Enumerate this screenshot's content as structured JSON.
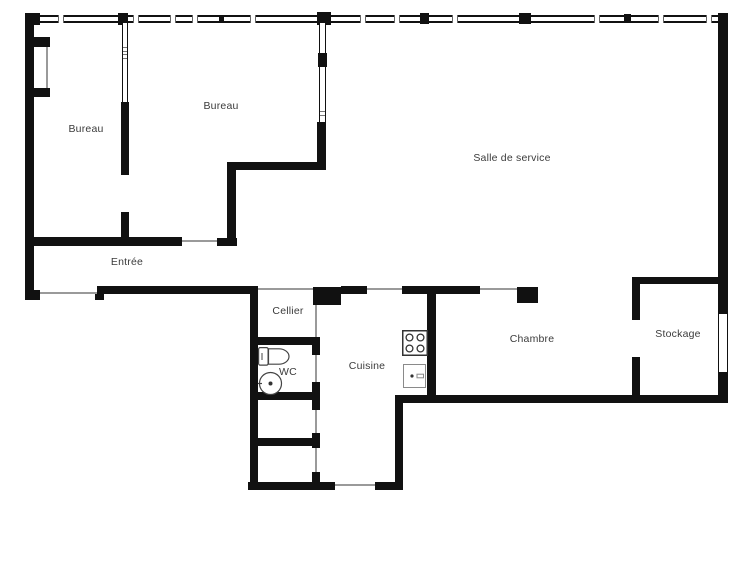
{
  "floorplan": {
    "title": "Apartment floor plan",
    "rooms": [
      {
        "id": "bureau-1",
        "label": "Bureau"
      },
      {
        "id": "bureau-2",
        "label": "Bureau"
      },
      {
        "id": "salle-de-service",
        "label": "Salle de service"
      },
      {
        "id": "entree",
        "label": "Entrée"
      },
      {
        "id": "cellier",
        "label": "Cellier"
      },
      {
        "id": "wc",
        "label": "WC"
      },
      {
        "id": "cuisine",
        "label": "Cuisine"
      },
      {
        "id": "chambre",
        "label": "Chambre"
      },
      {
        "id": "stockage",
        "label": "Stockage"
      }
    ],
    "fixtures": [
      {
        "icon": "stove-icon",
        "room": "cuisine",
        "burners": 4
      },
      {
        "icon": "oven-icon",
        "room": "cuisine"
      },
      {
        "icon": "toilet-icon",
        "room": "wc"
      },
      {
        "icon": "sink-icon",
        "room": "wc"
      }
    ],
    "features": {
      "window_wall_top": true,
      "window_right_wall": true,
      "glazed_partitions": 2
    },
    "colors": {
      "wall": "#111111",
      "opening_line": "#9a9a9a",
      "label_text": "#3b3b3b",
      "background": "#ffffff"
    }
  }
}
